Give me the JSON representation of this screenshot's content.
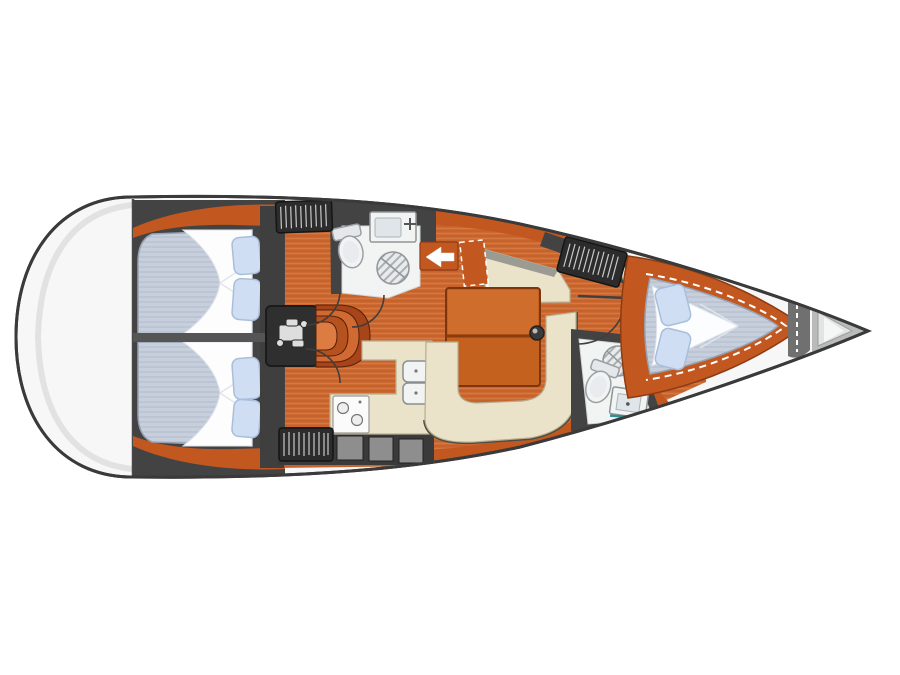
{
  "diagram": {
    "type": "yacht-interior-floor-plan",
    "orientation": "bow-right",
    "visible_text": []
  },
  "colors": {
    "hull_outline": "#3a3a3a",
    "deck": "#f7f7f7",
    "floor_teak": "#cd6a32",
    "floor_stripe": "#bf5b27",
    "joinery_orange": "#c2581f",
    "upholstery_cream": "#ebe3c9",
    "mattress_blue_gray": "#c6cfdb",
    "pillow_blue": "#cfdef2",
    "bulkhead_dark": "#434343",
    "fixture_white": "#f2f4f4",
    "accent_teal": "#2e8f96",
    "arrow_white": "#ffffff"
  },
  "rooms": [
    {
      "id": "stern-deck",
      "name": "Stern deck"
    },
    {
      "id": "aft-cabin-port",
      "name": "Aft double cabin (port)",
      "features": [
        "double berth",
        "two pillows",
        "deck hatch"
      ]
    },
    {
      "id": "aft-cabin-starboard",
      "name": "Aft double cabin (starboard)",
      "features": [
        "double berth",
        "two pillows",
        "deck hatch"
      ]
    },
    {
      "id": "engine-room",
      "name": "Engine compartment"
    },
    {
      "id": "companionway",
      "name": "Companionway steps",
      "arrow_direction": "left"
    },
    {
      "id": "aft-head",
      "name": "Aft head (WC / shower)",
      "features": [
        "washbasin",
        "toilet",
        "shower"
      ]
    },
    {
      "id": "galley",
      "name": "Galley",
      "features": [
        "stove",
        "double sink",
        "lockers"
      ]
    },
    {
      "id": "saloon",
      "name": "Saloon",
      "features": [
        "straight settee",
        "table",
        "mast post",
        "U-shaped settee"
      ]
    },
    {
      "id": "forward-head",
      "name": "Forward head (WC / shower)",
      "features": [
        "toilet",
        "shower",
        "washbasin"
      ]
    },
    {
      "id": "forward-cabin",
      "name": "Forward V-berth cabin",
      "features": [
        "V-berth",
        "two pillows",
        "shelf"
      ]
    },
    {
      "id": "bow-deck",
      "name": "Bow deck"
    }
  ],
  "hatches": [
    "aft coachroof hatch",
    "forward coachroof hatch",
    "galley coachroof hatch"
  ]
}
